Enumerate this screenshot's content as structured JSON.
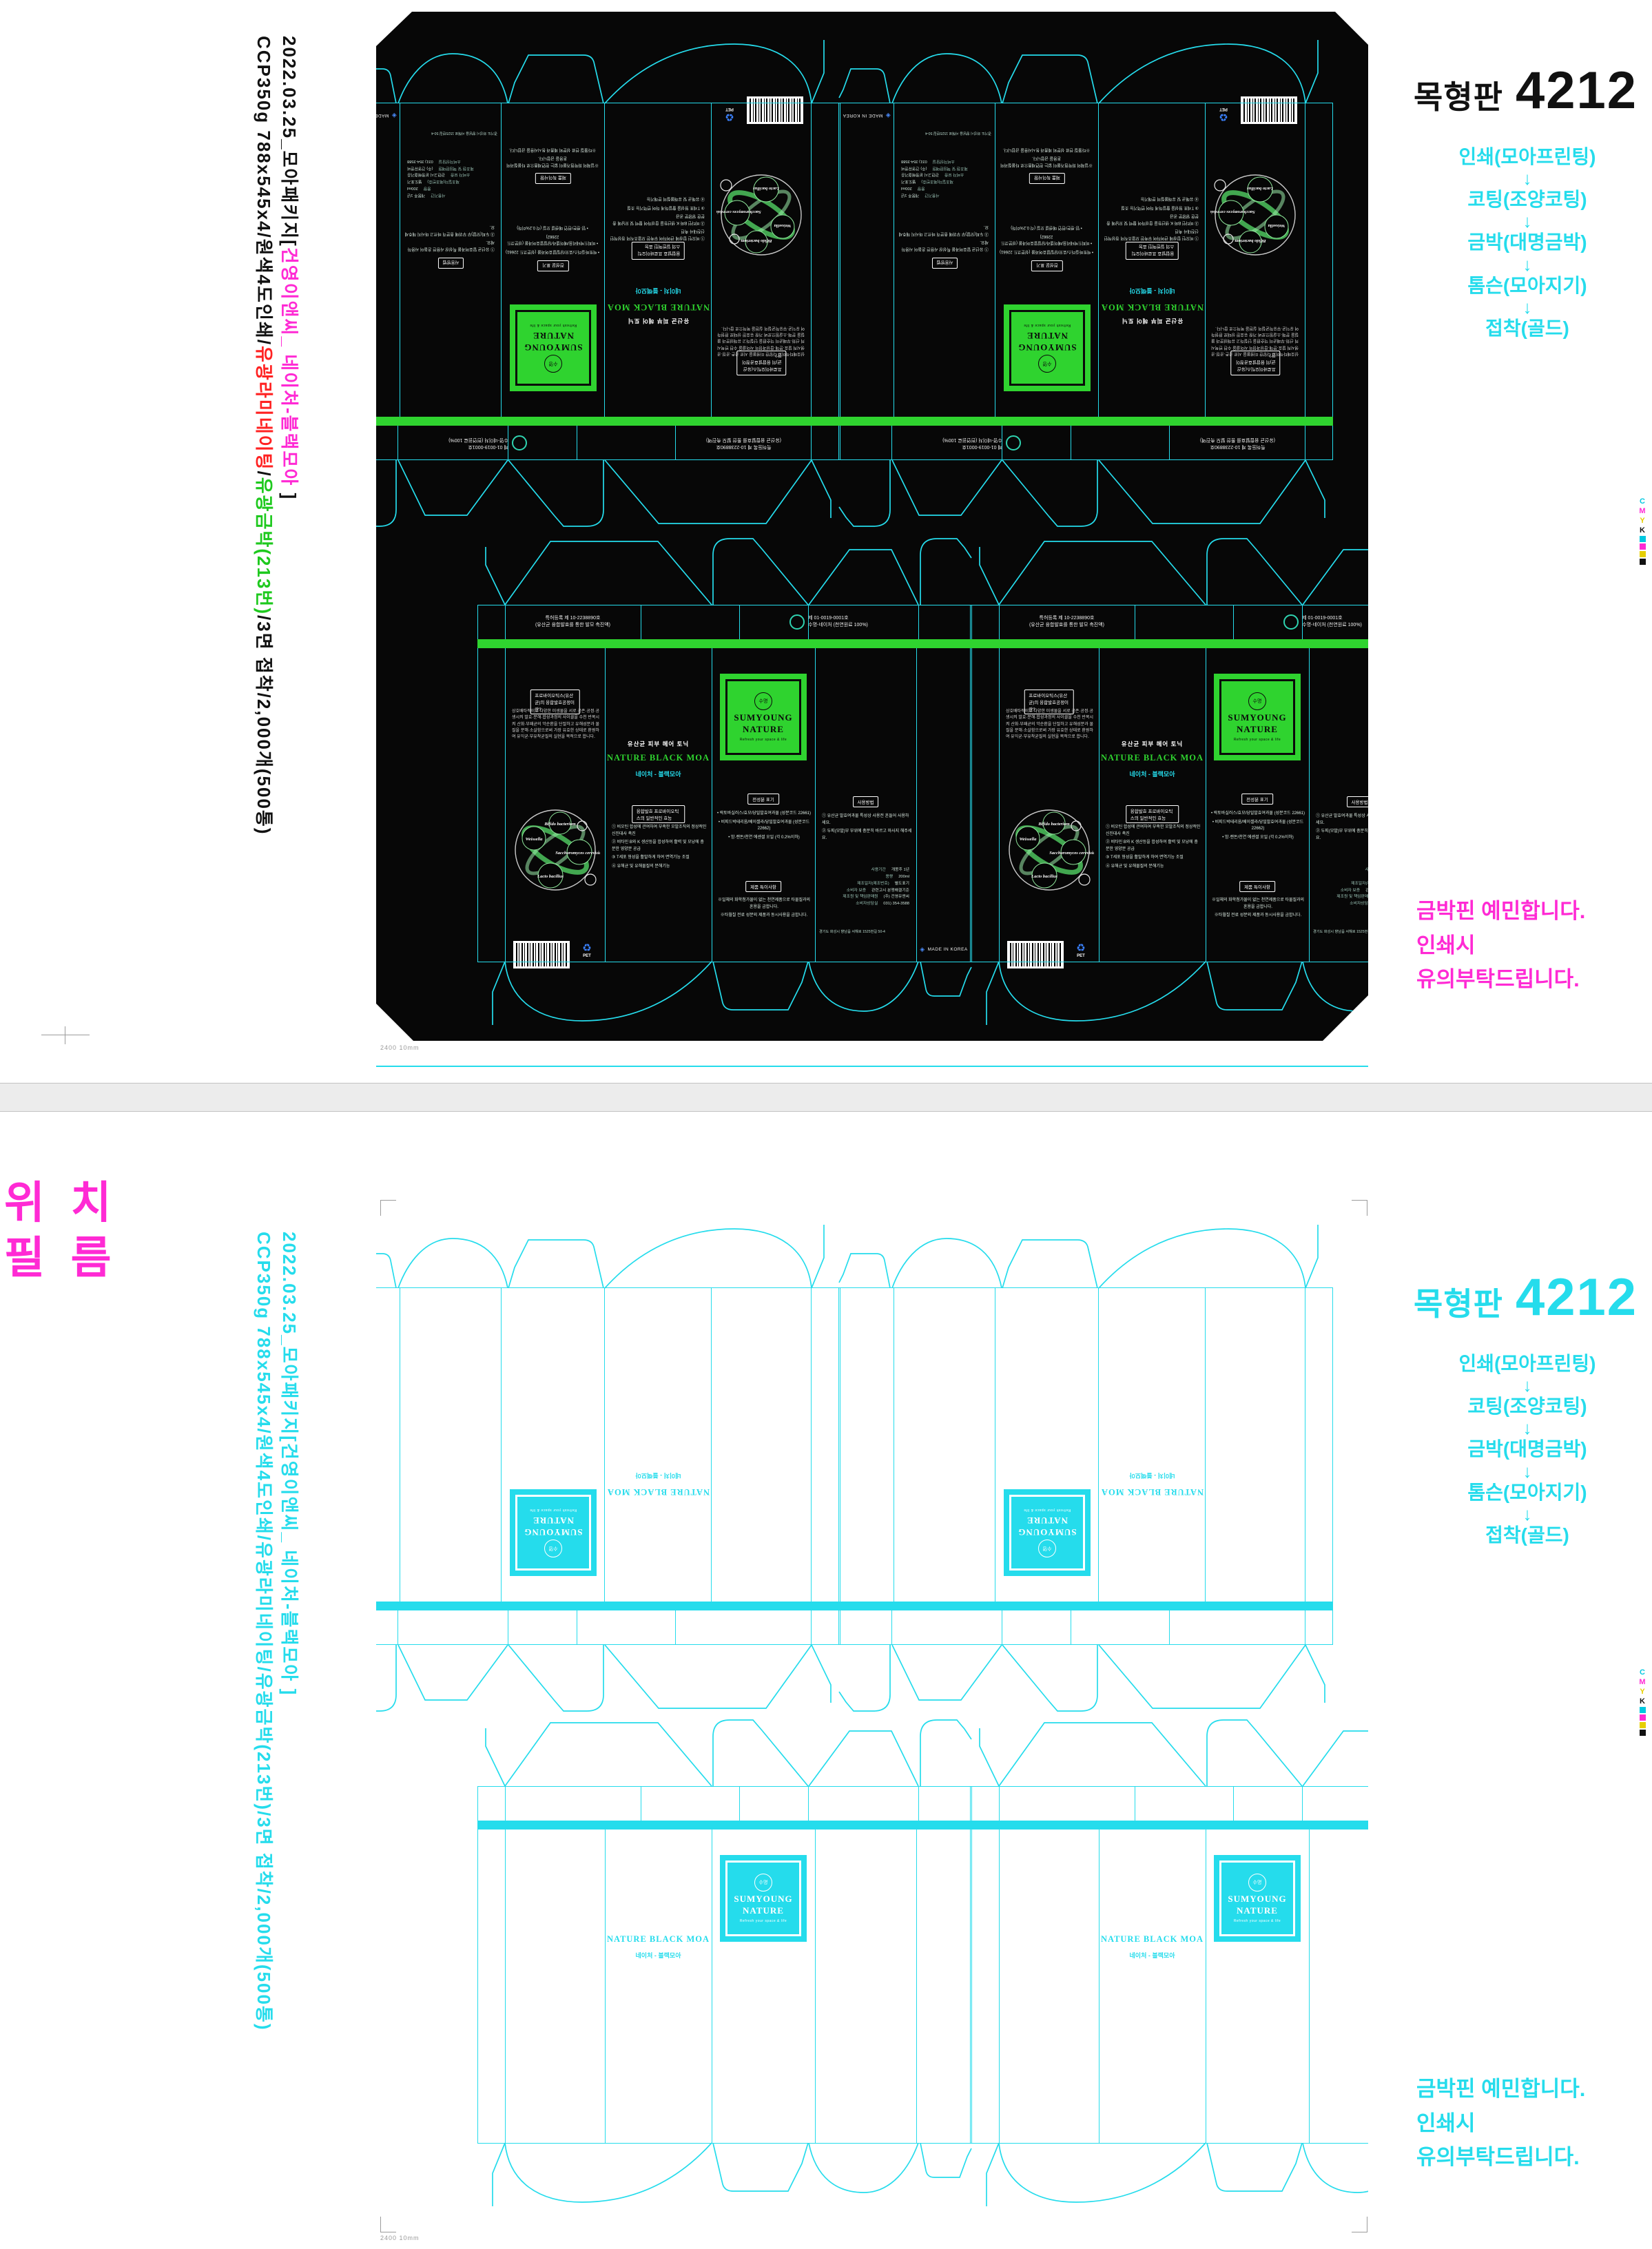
{
  "sheet": {
    "top_info_line1": {
      "prefix": "2022.03.25_모아패키지[",
      "highlight": "건영이앤씨_ 네이처-블랙모아",
      "suffix": " ]"
    },
    "top_info_line2": {
      "p1": "CCP350g 788x545x4/원색4도인쇄/",
      "lam": "유광라미네이팅",
      "slash": "/",
      "foil": "유광금박(213번)",
      "p2": "/3면 접착/2,000개(500통)"
    },
    "bottom_info_line1": "2022.03.25_모아패키지[건영이앤씨_ 네이처-블랙모아 ]",
    "bottom_info_line2": "CCP350g 788x545x4/원색4도인쇄/유광라미네이팅/유광금박(213번)/3면 접착/2,000개(500통)",
    "plate_title_label": "목형판",
    "plate_title_number": "4212",
    "process_steps": [
      "인쇄(모아프린팅)",
      "코팅(조양코팅)",
      "금박(대명금박)",
      "톰슨(모아지기)",
      "접착(골드)"
    ],
    "arrow": "↓",
    "note_line1": "금박핀 예민합니다.",
    "note_line2": "인쇄시",
    "note_line3": "유의부탁드립니다.",
    "position_film_label": "위 치\n필 름",
    "ruler_note": "2400 10mm",
    "cmyk_letters": [
      "C",
      "M",
      "Y",
      "K"
    ]
  },
  "box": {
    "crest": "수명",
    "brand_top": "SUMYOUNG",
    "brand_bottom": "NATURE",
    "tagline": "Refresh your space & life",
    "product_type": "유산균 피부 헤어 토닉",
    "name_en": "NATURE BLACK MOA",
    "name_kr": "네이처 - 블랙모아",
    "back_heading": "프로바이오틱스(유산균)의 융합발효공정이란?",
    "back_text": "상호배타적이고 다양한 미생물을 서로 공존·공정·공생시켜 발효·분해·합성과정의 사이클을 수천 반복시켜 산화·부패균의 악순환을 단절하고 유해성분과 물질을 분해·소살함으로써 가장 유효한 상태로 환원하여 유익균·부유착균질의 실현을 목적으로 합니다.",
    "diagram_labels": [
      "Weissella",
      "Bifido bacterium",
      "Saccharomyces cerevisiae",
      "Lacto bacillus"
    ],
    "efficacy_heading": "융합발효 프로바이오틱스의 일반적인 효능",
    "efficacy_items": [
      "① 비오틴 합성에 관여하여 부족한 모발조직의 정상적인 신진대사 촉진",
      "② 비타민 B와 K 생산등을 합성하여 활력 및 모낭에 충분한 영양분 공급",
      "③ T세포 형성을 활발하게 하여 면역기능 조절",
      "④ 유해균 및 유해물질의 분해기능"
    ],
    "ingredients_heading": "전성분 표기",
    "ingredients_items": [
      "• 락토바실러스/효모/당밀발효여과물 (성분코드 22661)",
      "• 비피드박테리움/베이셀라/당밀발효여과물 (성분코드 22662)",
      "• 밤·랜돈/천연 에센셜 오일 (각 0.2%이하)"
    ],
    "special_heading": "제품 특이사항",
    "special_lines": [
      "※일체의 화학첨가물이 없는 천연제품으로 타물질과의 혼용을 금합니다.",
      "※타월칠 전료 성분외 제품과 동시사용을 금합니다."
    ],
    "usage_heading": "사용방법",
    "usage_items": [
      "① 유산균 발효여과물 특성상 사용전 흔들어 사용하세요.",
      "② 두피(모발)부 부위에 충분히 바르고 마사지 해주세요."
    ],
    "spec_rows": [
      [
        "사용기간",
        "개봉후 1년"
      ],
      [
        "용량",
        "200ml"
      ],
      [
        "제조일자(제조번호)",
        "별도표기"
      ],
      [
        "소비자 보증",
        "관련고시 분쟁해결기준"
      ],
      [
        "제조원 및 책임판매원",
        "(주) 건영유앤씨"
      ],
      [
        "소비자상담실",
        "031) 354-3588"
      ]
    ],
    "address": "경기도 화성시 향남읍 서해로 1525번길 50-4",
    "patent_line1": "특허등록 제 10-2238890호",
    "patent_line2": "(유산균 융합발효를 통한 발모 촉진액)",
    "cert_line1": "제 01-0019-0001호",
    "cert_line2": "수명-네이처 (천연원료 100%)",
    "made_in": "MADE IN KOREA",
    "pet": "PET"
  },
  "colors": {
    "cyan": "#25dcec",
    "green": "#2fd32f",
    "magenta": "#ff2ad4",
    "red": "#ff2222",
    "foil_green": "#1ec91e",
    "plate_black": "#070707"
  }
}
